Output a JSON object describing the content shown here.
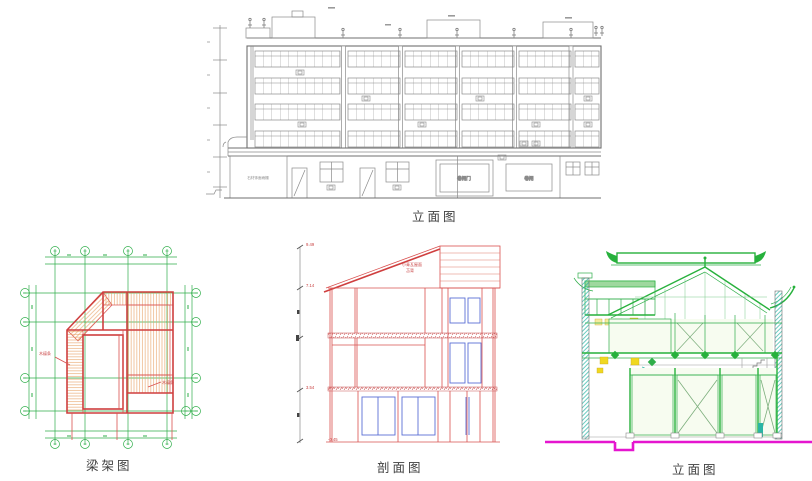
{
  "captions": {
    "top_elevation": "立面图",
    "framing_plan": "梁架图",
    "section": "剖面图",
    "right_elevation": "立面图"
  },
  "top_elevation": {
    "shutter_door_label": "卷闸门",
    "shutter_label": "卷闸",
    "canopy_note": "石材饰面雨棚"
  },
  "framing_plan": {
    "leader_left": "木檩条",
    "leader_right": "木檩条"
  },
  "section": {
    "roof_note1": "小青瓦屋面",
    "roof_note2": "苫背",
    "levels": [
      "9.49",
      "7.14",
      "3.54",
      "-0.45"
    ]
  },
  "colors": {
    "cad_gray": "#8a8a8a",
    "red": "#d9504f",
    "green": "#2fae4a",
    "blue": "#5b6fd4",
    "magenta": "#e515cf",
    "teal": "#2ab5a5",
    "yellow": "#f0d820",
    "hatch_orange": "#e8a267"
  }
}
